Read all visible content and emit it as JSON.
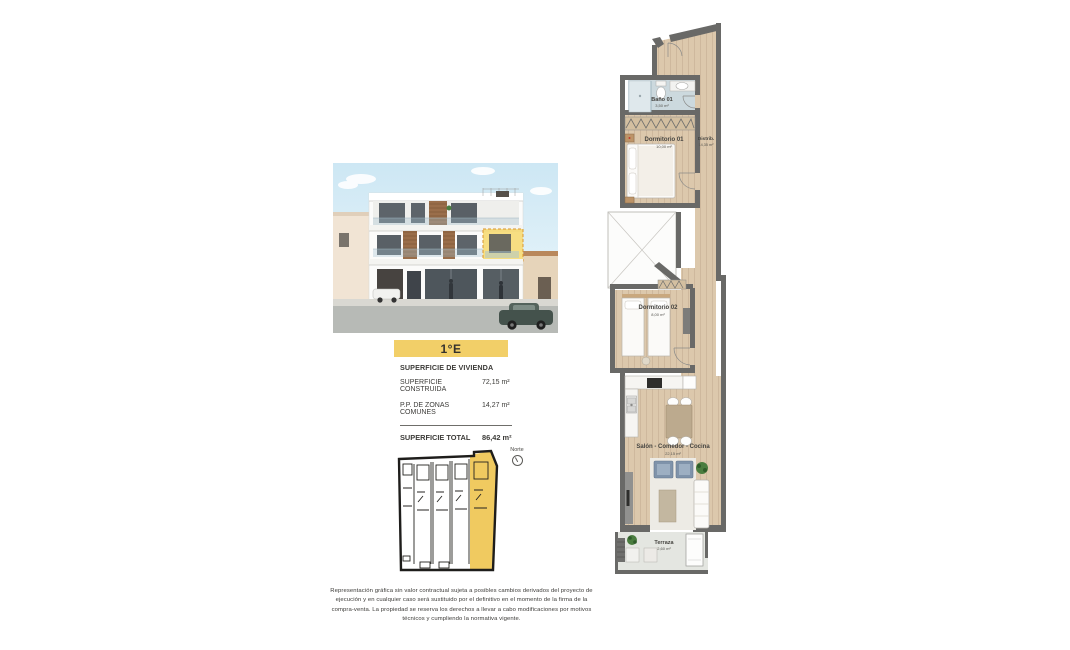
{
  "unit": {
    "badge": "1°E"
  },
  "surfaces": {
    "header": "SUPERFICIE DE VIVIENDA",
    "rows": [
      {
        "label": "SUPERFICIE CONSTRUIDA",
        "value": "72,15 m²"
      },
      {
        "label": "P.P. DE ZONAS COMUNES",
        "value": "14,27 m²"
      }
    ],
    "total": {
      "label": "SUPERFICIE TOTAL",
      "value": "86,42 m²"
    }
  },
  "floorplan": {
    "compass_label": "Norte",
    "rooms": [
      {
        "name": "Baño 01",
        "area": "3,50 m²"
      },
      {
        "name": "Dormitorio 01",
        "area": "10,00 m²"
      },
      {
        "name": "Distrib.",
        "area": "14,35 m²"
      },
      {
        "name": "Dormitorio 02",
        "area": "8,00 m²"
      },
      {
        "name": "Salón - Comedor - Cocina",
        "area": "22,15 m²"
      },
      {
        "name": "Terraza",
        "area": "2,60 m²"
      }
    ]
  },
  "disclaimer": "Representación gráfica sin valor contractual sujeta a posibles cambios derivados del proyecto de ejecución y en cualquier caso será sustituido por el definitivo en el momento de la firma de la compra-venta. La propiedad se reserva los derechos a llevar a cabo modificaciones por motivos técnicos y cumpliendo la normativa vigente.",
  "colors": {
    "accent_yellow": "#f2cf68",
    "wall_gray": "#696967",
    "wood_floor": "#dcc8ac",
    "bath_floor": "#ccd9de",
    "terrace_floor": "#e4e6e1"
  }
}
